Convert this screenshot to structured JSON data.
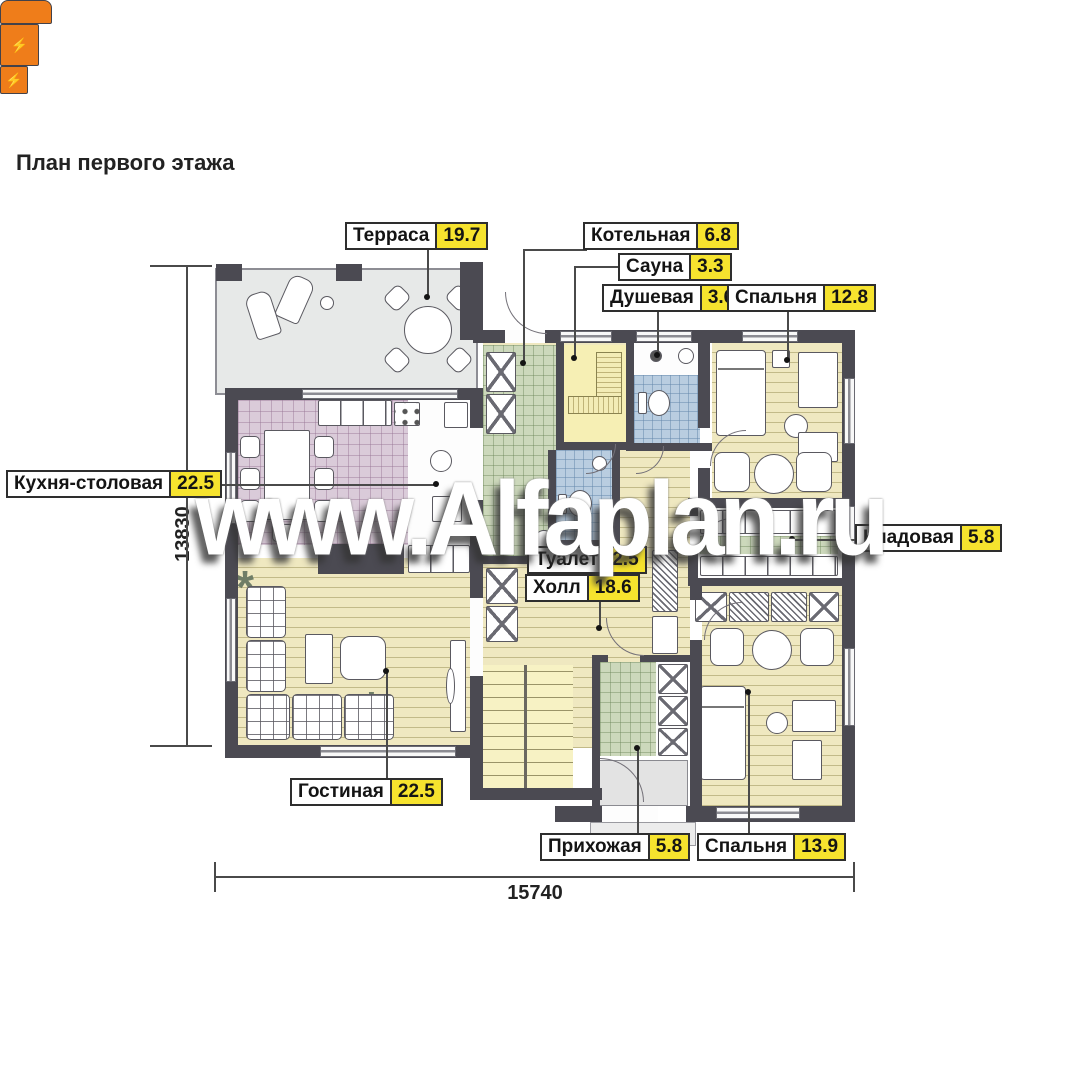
{
  "title": "План первого этажа",
  "watermark": "www.Alfaplan.ru",
  "dimensions": {
    "height_mm": "13830",
    "width_mm": "15740"
  },
  "labels": {
    "terrace": {
      "name": "Терраса",
      "area": "19.7"
    },
    "boiler": {
      "name": "Котельная",
      "area": "6.8"
    },
    "sauna": {
      "name": "Сауна",
      "area": "3.3"
    },
    "shower": {
      "name": "Душевая",
      "area": "3.6"
    },
    "bedroom1": {
      "name": "Спальня",
      "area": "12.8"
    },
    "kitchen": {
      "name": "Кухня-столовая",
      "area": "22.5"
    },
    "pantry": {
      "name": "Кладовая",
      "area": "5.8"
    },
    "toilet": {
      "name": "Туалет",
      "area": "2.5"
    },
    "hall": {
      "name": "Холл",
      "area": "18.6"
    },
    "living": {
      "name": "Гостиная",
      "area": "22.5"
    },
    "entry": {
      "name": "Прихожая",
      "area": "5.8"
    },
    "bedroom2": {
      "name": "Спальня",
      "area": "13.9"
    }
  },
  "icons": {
    "lightning": "⚡",
    "plant": "*"
  },
  "palette": {
    "wall": "#4b4a52",
    "wood_floor": "#efe8c0",
    "kitchen_tile": "#dacbd9",
    "boiler_tile": "#ccd8bb",
    "wet_tile": "#b9cde0",
    "sauna_floor": "#f6efb4",
    "terrace_floor": "#e7e9e8",
    "stairs": "#f7f2c4",
    "area_badge": "#f6e32e",
    "accent_orange": "#ef7d1a"
  }
}
